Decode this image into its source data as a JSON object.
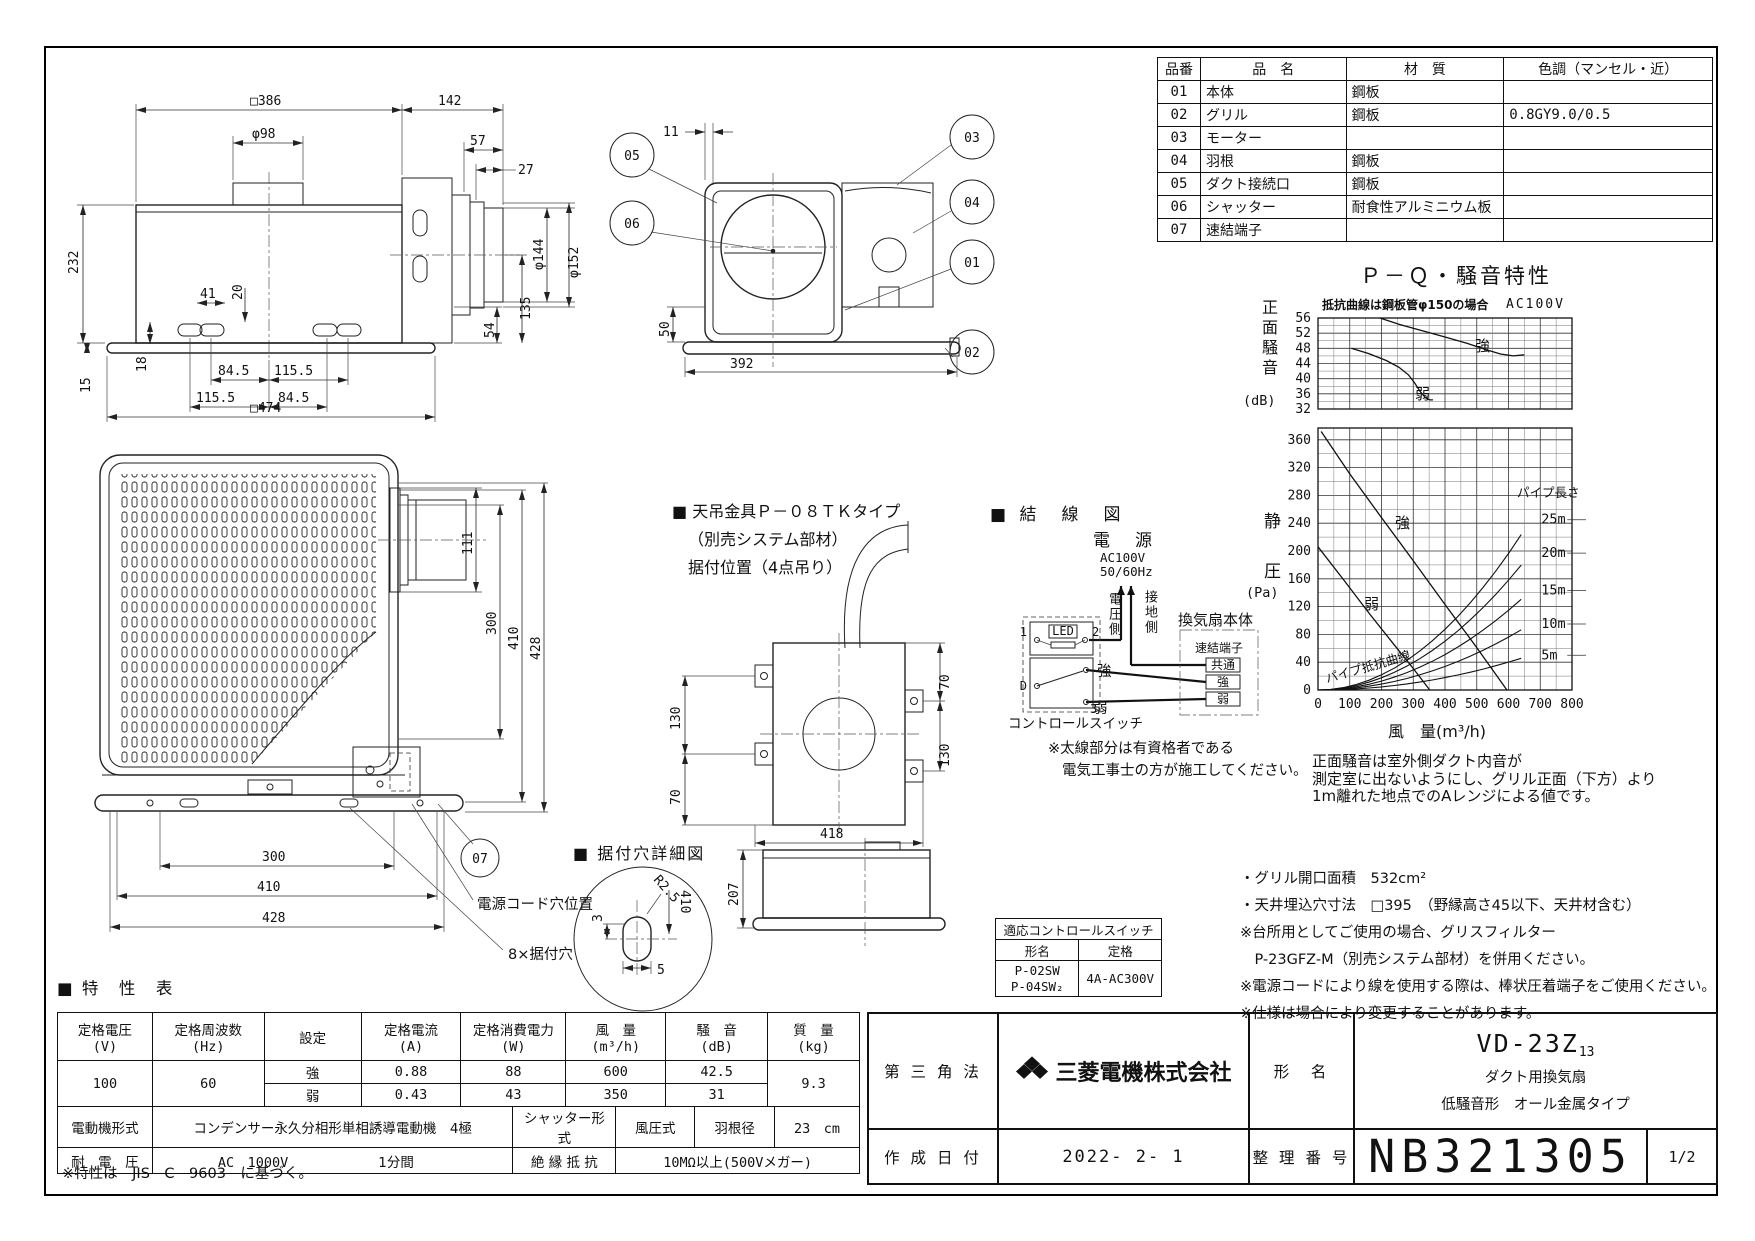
{
  "parts_table": {
    "headers": [
      "品番",
      "品　名",
      "材　質",
      "色調（マンセル・近）"
    ],
    "rows": [
      {
        "no": "01",
        "name": "本体",
        "material": "鋼板",
        "color": ""
      },
      {
        "no": "02",
        "name": "グリル",
        "material": "鋼板",
        "color": "0.8GY9.0/0.5"
      },
      {
        "no": "03",
        "name": "モーター",
        "material": "",
        "color": ""
      },
      {
        "no": "04",
        "name": "羽根",
        "material": "鋼板",
        "color": ""
      },
      {
        "no": "05",
        "name": "ダクト接続口",
        "material": "鋼板",
        "color": ""
      },
      {
        "no": "06",
        "name": "シャッター",
        "material": "耐食性アルミニウム板",
        "color": ""
      },
      {
        "no": "07",
        "name": "速結端子",
        "material": "",
        "color": ""
      }
    ]
  },
  "chart_data": {
    "type": "line",
    "title": "Ｐ－Ｑ・騒音特性",
    "condition_note": "抵抗曲線は鋼板管φ150の場合",
    "voltage_note": "AC100V",
    "xlabel": "風　量(m³/h)",
    "x_range": [
      0,
      800
    ],
    "x_major_tick": 100,
    "noise_plot": {
      "ylabel": "正面騒音",
      "yunit": "(dB)",
      "y_range": [
        32,
        56
      ],
      "y_ticks": [
        56,
        52,
        48,
        44,
        40,
        36,
        32
      ],
      "series": [
        {
          "name": "強",
          "points": [
            [
              195,
              56
            ],
            [
              260,
              54.2
            ],
            [
              330,
              52.6
            ],
            [
              400,
              51.0
            ],
            [
              470,
              49.3
            ],
            [
              530,
              47.6
            ],
            [
              575,
              46.5
            ],
            [
              615,
              46.0
            ],
            [
              650,
              46.3
            ]
          ]
        },
        {
          "name": "弱",
          "points": [
            [
              105,
              48.0
            ],
            [
              160,
              46.6
            ],
            [
              215,
              44.8
            ],
            [
              255,
              43.0
            ],
            [
              285,
              41.0
            ],
            [
              305,
              38.8
            ],
            [
              322,
              36.6
            ],
            [
              338,
              35.0
            ],
            [
              352,
              34.4
            ],
            [
              362,
              34.4
            ]
          ]
        }
      ]
    },
    "pressure_plot": {
      "ylabel": "静　圧",
      "yunit": "(Pa)",
      "y_range": [
        0,
        377
      ],
      "y_ticks": [
        360,
        320,
        280,
        240,
        200,
        160,
        120,
        80,
        40,
        0
      ],
      "fan_curves": [
        {
          "name": "強",
          "points": [
            [
              10,
              372
            ],
            [
              100,
              311
            ],
            [
              200,
              248
            ],
            [
              300,
              186
            ],
            [
              400,
              123
            ],
            [
              500,
              61
            ],
            [
              595,
              0
            ]
          ]
        },
        {
          "name": "弱",
          "points": [
            [
              0,
              206
            ],
            [
              80,
              159
            ],
            [
              160,
              111
            ],
            [
              240,
              65
            ],
            [
              300,
              31
            ],
            [
              352,
              0
            ]
          ]
        }
      ],
      "pipe_curves": {
        "group_label": "パイプ長さ",
        "curve_label": "パイプ抵抗曲線",
        "lengths": [
          "25m",
          "20m",
          "15m",
          "10m",
          "5m"
        ],
        "pressure_at_q670": [
          245,
          197,
          143,
          95,
          50
        ]
      }
    },
    "note_lines": [
      "正面騒音は室外側ダクト内音が",
      "測定室に出ないようにし、グリル正面（下方）より",
      "1m離れた地点でのAレンジによる値です。"
    ]
  },
  "views": {
    "side": {
      "dims": {
        "w386": "□386",
        "d142": "142",
        "dia98": "φ98",
        "d57": "57",
        "d27": "27",
        "h232": "232",
        "d41": "41",
        "d20": "20",
        "d18": "18",
        "d15": "15",
        "p845a": "84.5",
        "p1155a": "115.5",
        "p1155b": "115.5",
        "p845b": "84.5",
        "w474": "□474",
        "d54": "54",
        "d135": "135",
        "dia144": "φ144",
        "dia152": "φ152"
      }
    },
    "section": {
      "callouts": [
        "05",
        "06",
        "03",
        "04",
        "01",
        "02"
      ],
      "dims": {
        "d11": "11",
        "d50": "50",
        "d392": "392"
      }
    },
    "grill": {
      "dims": {
        "d111": "111",
        "v300": "300",
        "v410": "410",
        "v428": "428",
        "b300": "300",
        "b410": "410",
        "b428": "428"
      },
      "callout": "07",
      "cord_label": "電源コード穴位置",
      "holes_label": "8×据付穴"
    },
    "hanger": {
      "title_lines": [
        "■ 天吊金具Ｐ－０８ＴＫタイプ",
        "（別売システム部材）",
        "据付位置（4点吊り）"
      ],
      "dims": {
        "left_top": "130",
        "left_bottom": "70",
        "right_top": "70",
        "right_bottom": "130",
        "width": "418"
      }
    },
    "profile": {
      "dims": {
        "h207": "207"
      }
    },
    "hole_detail": {
      "title": "■ 据付穴詳細図",
      "dims": {
        "offset": "3",
        "radius": "R2.5",
        "pitch": "410",
        "width": "5"
      }
    }
  },
  "wiring": {
    "title": "■ 結　線　図",
    "power_label": "電　源",
    "power_spec1": "AC100V",
    "power_spec2": "50/60Hz",
    "hot_label": "電圧側",
    "ground_label": "接地側",
    "led_label": "LED",
    "t1": "1",
    "t2": "2",
    "td": "D",
    "t3": "3",
    "strong": "強",
    "weak": "弱",
    "switch_label": "コントロールスイッチ",
    "fan_label": "換気扇本体",
    "terminal_label": "速結端子",
    "fan_terminals": [
      "共通",
      "強",
      "弱"
    ],
    "note_lines": [
      "※太線部分は有資格者である",
      "電気工事士の方が施工してください。"
    ]
  },
  "notes_right": [
    "・グリル開口面積　532cm²",
    "・天井埋込穴寸法　□395　（野縁高さ45以下、天井材含む）",
    "※台所用としてご使用の場合、グリスフィルター",
    "　P-23GFZ-M（別売システム部材）を併用ください。",
    "※電源コードにより線を使用する際は、棒状圧着端子をご使用ください。",
    "※仕様は場合により変更することがあります。"
  ],
  "control_switch_table": {
    "title": "適応コントロールスイッチ",
    "model_header": "形名",
    "rating_header": "定格",
    "models": [
      "P-02SW",
      "P-04SW₂"
    ],
    "rating": "4A-AC300V"
  },
  "spec_table": {
    "title": "■ 特　性　表",
    "headers": [
      {
        "l1": "定格電圧",
        "l2": "(V)"
      },
      {
        "l1": "定格周波数",
        "l2": "(Hz)"
      },
      {
        "l1": "設定",
        "l2": ""
      },
      {
        "l1": "定格電流",
        "l2": "(A)"
      },
      {
        "l1": "定格消費電力",
        "l2": "(W)"
      },
      {
        "l1": "風　量",
        "l2": "(m³/h)"
      },
      {
        "l1": "騒　音",
        "l2": "(dB)"
      },
      {
        "l1": "質　量",
        "l2": "(kg)"
      }
    ],
    "voltage": "100",
    "frequency": "60",
    "rows": [
      {
        "setting": "強",
        "current": "0.88",
        "power": "88",
        "airflow": "600",
        "noise": "42.5"
      },
      {
        "setting": "弱",
        "current": "0.43",
        "power": "43",
        "airflow": "350",
        "noise": "31"
      }
    ],
    "weight": "9.3",
    "motor_label": "電動機形式",
    "motor_value": "コンデンサー永久分相形単相誘導電動機　4極",
    "shutter_label": "シャッター形式",
    "shutter_value": "風圧式",
    "blade_label": "羽根径",
    "blade_value": "23　cm",
    "withstand_label": "耐　電　圧",
    "withstand_value": "AC　1000V",
    "withstand_time": "1分間",
    "insulation_label": "絶 縁 抵 抗",
    "insulation_value": "10MΩ以上(500Vメガー)",
    "footnote": "※特性は　JIS　C　9603　に基づく。"
  },
  "title_block": {
    "projection": "第 三 角 法",
    "company": "三菱電機株式会社",
    "model_label": "形　名",
    "model": "VD-23Z",
    "model_sub": "13",
    "product_line1": "ダクト用換気扇",
    "product_line2": "低騒音形　オール金属タイプ",
    "date_label": "作 成 日 付",
    "date": "2022- 2- 1",
    "number_label": "整 理 番 号",
    "number": "NB321305",
    "page": "1/2"
  }
}
